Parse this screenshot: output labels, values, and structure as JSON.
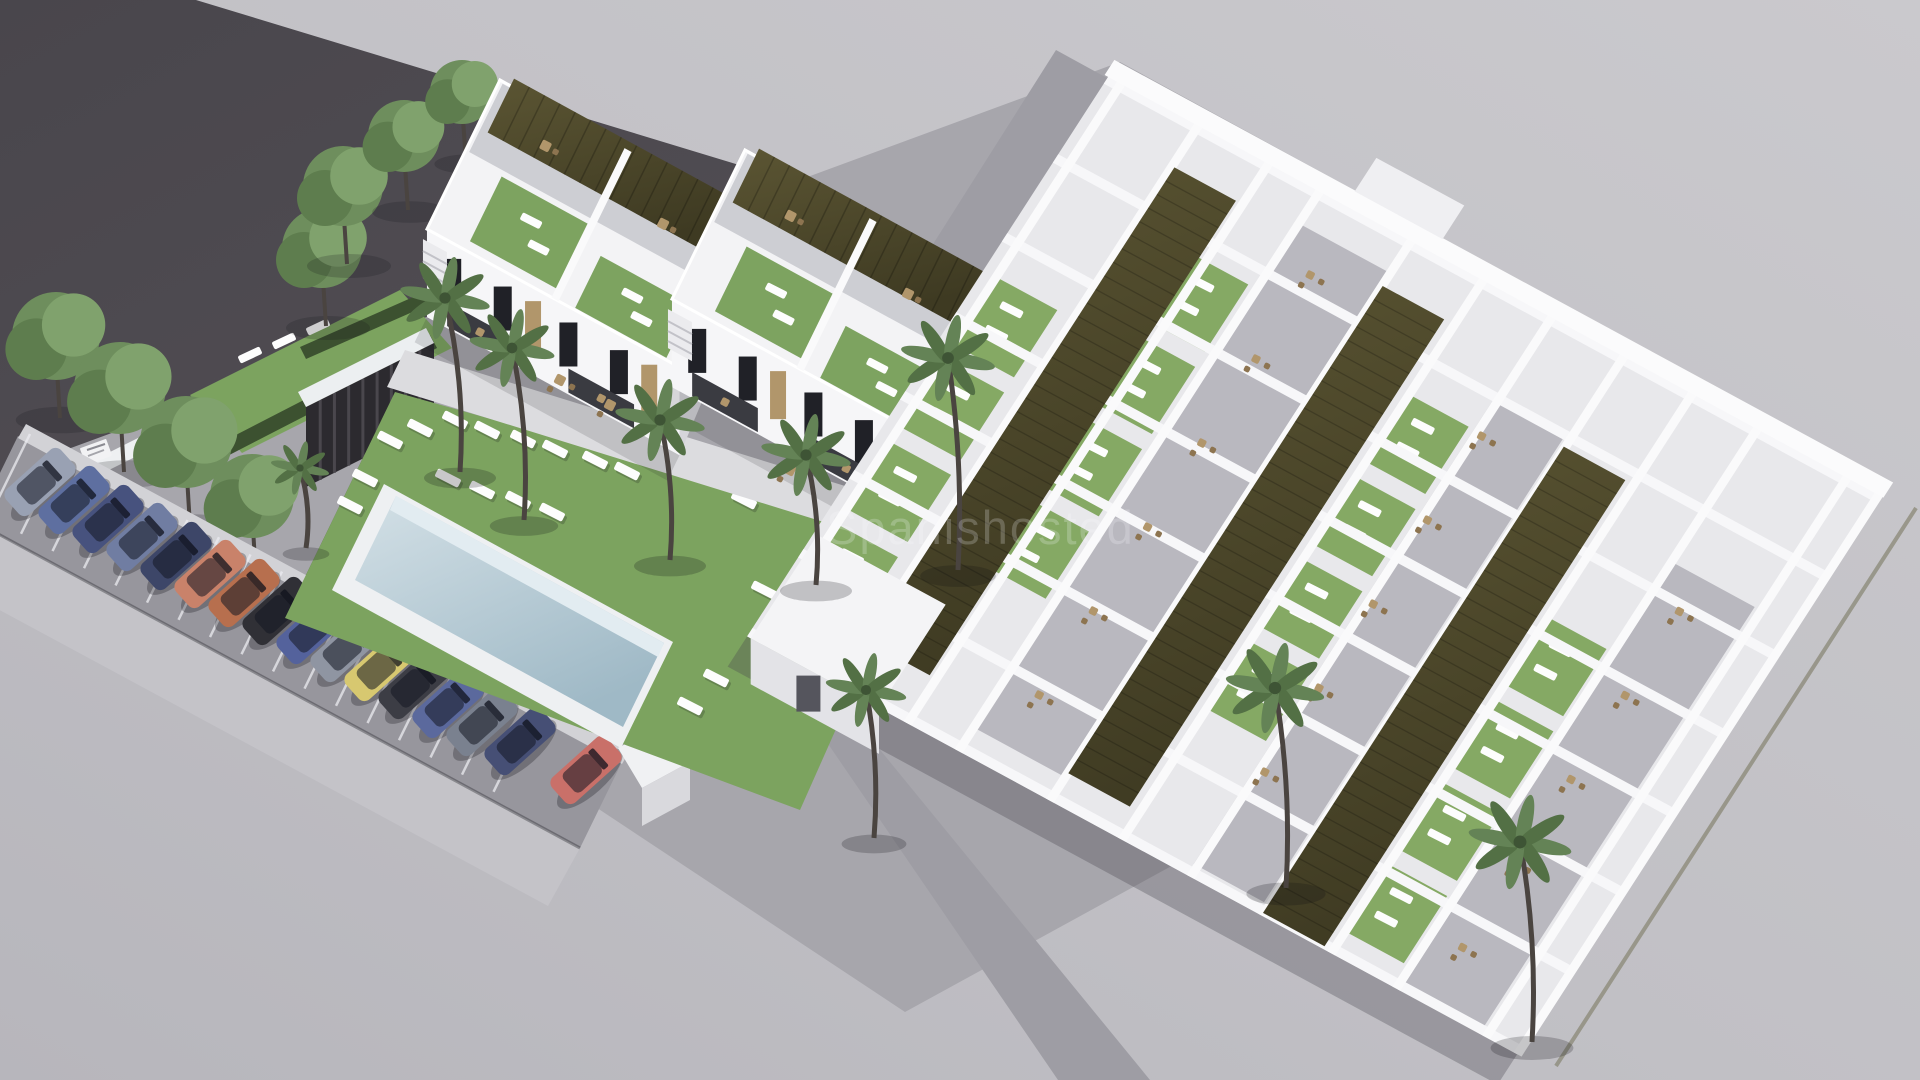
{
  "watermark": {
    "text": "Spanishosted"
  },
  "scene": {
    "type": "3d-architectural-render",
    "description": "Aerial render of a white residential development: two-storey townhouses with olive pergola roof terraces, communal lawn with swimming pool and sun loungers, palm trees, angle-parked cars along the street, and a large single-storey apartment complex with three long olive pergola strips, green patios and grey terraces.",
    "palette": {
      "bgLight": "#cac9cd",
      "bgDark": "#b7b6bc",
      "parcel1": "#49464c",
      "parcel2": "#5e5a60",
      "site": "#a7a6ac",
      "road": "#9e9da4",
      "asphalt": "#97969d",
      "sidewalk": "#c4c3c8",
      "lawn": "#7ca35f",
      "lawnBright": "#86ab66",
      "hedge": "#3c5130",
      "poolRim": "#eef0f2",
      "water1": "#d3e0e6",
      "water2": "#9fb9c6",
      "waterEdge": "#e2ecf1",
      "white": "#f6f6f8",
      "whiteShade": "#d5d5da",
      "whiteDark": "#bfbfc5",
      "pergola1": "#5b5533",
      "pergola2": "#3e3a22",
      "turf": "#7da360",
      "tan": "#b1966b",
      "tanDark": "#8d7450",
      "window": "#202127",
      "recess": "#3a3b41",
      "trunk": "#4a4440",
      "frond1": "#537045",
      "frond2": "#648356",
      "tree1": "#6e8e5d",
      "tree2": "#80a26d",
      "tree3": "#5e7d4e",
      "slat": "#2c2a2f",
      "slatLine": "#4a474d"
    },
    "axes": {
      "U": [
        0.877,
        0.48
      ],
      "V": [
        -0.44,
        0.898
      ]
    },
    "parcel": [
      [
        0,
        0
      ],
      [
        196,
        0
      ],
      [
        1335,
        346
      ],
      [
        900,
        700
      ],
      [
        0,
        548
      ]
    ],
    "site": [
      [
        60,
        452
      ],
      [
        1120,
        62
      ],
      [
        1880,
        478
      ],
      [
        905,
        1012
      ]
    ],
    "roads": [
      [
        [
          1056,
          50
        ],
        [
          1118,
          84
        ],
        [
          760,
          646
        ],
        [
          700,
          612
        ]
      ],
      [
        [
          757,
          640
        ],
        [
          818,
          674
        ],
        [
          1150,
          1080
        ],
        [
          1058,
          1080
        ]
      ]
    ],
    "upperLawn": {
      "poly": [
        [
          190,
          395
        ],
        [
          400,
          290
        ],
        [
          452,
          348
        ],
        [
          242,
          453
        ]
      ],
      "loungers": [
        [
          250,
          355
        ],
        [
          284,
          341
        ],
        [
          318,
          327
        ]
      ]
    },
    "hedges": [
      [
        [
          168,
          470
        ],
        [
          430,
          335
        ],
        [
          437,
          348
        ],
        [
          175,
          483
        ]
      ],
      [
        [
          300,
          347
        ],
        [
          470,
          272
        ],
        [
          476,
          284
        ],
        [
          306,
          359
        ]
      ],
      [
        [
          285,
          618
        ],
        [
          395,
          392
        ],
        [
          403,
          398
        ],
        [
          293,
          624
        ]
      ]
    ],
    "slatBuilding": {
      "cap": [
        [
          298,
          392
        ],
        [
          426,
          328
        ],
        [
          434,
          343
        ],
        [
          306,
          407
        ]
      ],
      "front": [
        [
          306,
          407
        ],
        [
          434,
          343
        ],
        [
          434,
          423
        ],
        [
          306,
          487
        ]
      ],
      "slats": 9
    },
    "sign": {
      "x": 96,
      "y": 452,
      "w": 28,
      "h": 18,
      "rot": -20
    },
    "gateWall": [
      [
        82,
        466
      ],
      [
        158,
        428
      ],
      [
        165,
        442
      ],
      [
        89,
        480
      ]
    ],
    "trees": [
      [
        56,
        336,
        44
      ],
      [
        120,
        388,
        46
      ],
      [
        186,
        442,
        46
      ],
      [
        252,
        496,
        42
      ],
      [
        322,
        248,
        40
      ],
      [
        343,
        186,
        40
      ],
      [
        404,
        136,
        36
      ],
      [
        462,
        92,
        32
      ]
    ],
    "parking": {
      "asphalt": [
        [
          18,
          436
        ],
        [
          622,
          762
        ],
        [
          580,
          848
        ],
        [
          -24,
          522
        ]
      ],
      "sidewalk": [
        [
          -24,
          522
        ],
        [
          580,
          848
        ],
        [
          548,
          906
        ],
        [
          -56,
          580
        ]
      ],
      "lowWall": [
        [
          26,
          424
        ],
        [
          630,
          750
        ],
        [
          622,
          764
        ],
        [
          18,
          438
        ]
      ],
      "bays": {
        "start": [
          30,
          434
        ],
        "step": [
          31.5,
          17.2
        ],
        "count": 17,
        "len": 92
      },
      "endPillar": {
        "top": [
          [
            618,
            748
          ],
          [
            666,
            722
          ],
          [
            690,
            762
          ],
          [
            642,
            788
          ]
        ],
        "face": [
          [
            642,
            788
          ],
          [
            690,
            762
          ],
          [
            690,
            800
          ],
          [
            642,
            826
          ]
        ]
      },
      "carSize": {
        "len": 74,
        "wid": 34,
        "rot": -42
      },
      "cars": [
        {
          "x": 40,
          "y": 482,
          "color": "#99a1b3"
        },
        {
          "x": 74,
          "y": 500,
          "color": "#5e6fa0"
        },
        {
          "x": 108,
          "y": 519,
          "color": "#47527e"
        },
        {
          "x": 142,
          "y": 537,
          "color": "#707da2"
        },
        {
          "x": 176,
          "y": 556,
          "color": "#3d4668"
        },
        {
          "x": 210,
          "y": 574,
          "color": "#c9826a"
        },
        {
          "x": 244,
          "y": 593,
          "color": "#b76f4e"
        },
        {
          "x": 278,
          "y": 611,
          "color": "#303036"
        },
        {
          "x": 312,
          "y": 630,
          "color": "#54629c"
        },
        {
          "x": 346,
          "y": 648,
          "color": "#8f95a2"
        },
        {
          "x": 380,
          "y": 667,
          "color": "#d7c870"
        },
        {
          "x": 414,
          "y": 685,
          "color": "#3c3d45"
        },
        {
          "x": 448,
          "y": 704,
          "color": "#5b699d"
        },
        {
          "x": 482,
          "y": 722,
          "color": "#7a818f"
        },
        {
          "x": 520,
          "y": 741,
          "color": "#464f75"
        },
        {
          "x": 586,
          "y": 770,
          "color": "#c97069"
        }
      ]
    },
    "mainLawn": [
      [
        395,
        392
      ],
      [
        920,
        540
      ],
      [
        800,
        810
      ],
      [
        285,
        618
      ]
    ],
    "pool": {
      "rim": [
        [
          384,
          484
        ],
        [
          673,
          642
        ],
        [
          621,
          748
        ],
        [
          332,
          590
        ]
      ],
      "water": [
        [
          396,
          496
        ],
        [
          664,
          643
        ],
        [
          623,
          727
        ],
        [
          355,
          580
        ]
      ],
      "edge": [
        [
          396,
          496
        ],
        [
          664,
          643
        ],
        [
          658,
          657
        ],
        [
          390,
          510
        ]
      ]
    },
    "poolLoungers": [
      [
        455,
        420
      ],
      [
        487,
        430
      ],
      [
        523,
        439
      ],
      [
        555,
        449
      ],
      [
        595,
        460
      ],
      [
        627,
        471
      ],
      [
        448,
        478
      ],
      [
        482,
        490
      ],
      [
        518,
        500
      ],
      [
        552,
        512
      ],
      [
        390,
        440
      ],
      [
        420,
        428
      ],
      [
        365,
        478
      ],
      [
        350,
        505
      ],
      [
        744,
        500
      ],
      [
        764,
        590
      ],
      [
        716,
        678
      ],
      [
        690,
        706
      ]
    ],
    "pathBand": [
      [
        405,
        350
      ],
      [
        955,
        520
      ],
      [
        937,
        557
      ],
      [
        387,
        387
      ]
    ],
    "townhouses": [
      {
        "anchor": [
          500,
          80
        ]
      },
      {
        "anchor": [
          745,
          150
        ]
      }
    ],
    "townhouseSpec": {
      "du": 288,
      "dw": 166,
      "facadeH": 88,
      "pergola": {
        "u0": 12,
        "len": 262,
        "w0": -8,
        "w1": 52
      },
      "backTerrace": {
        "w0": 2,
        "w1": 78
      },
      "patches": [
        {
          "u": 44,
          "w": 84,
          "du": 104,
          "dw": 72
        },
        {
          "u": 168,
          "w": 106,
          "du": 104,
          "dw": 58
        }
      ],
      "roofTables": [
        {
          "u": 70,
          "w": 36
        },
        {
          "u": 210,
          "w": 48
        }
      ],
      "windows": [
        0.1,
        0.3,
        0.56,
        0.76
      ],
      "accents": [
        0.42,
        0.88
      ],
      "recesses": [
        {
          "f0": 0.08,
          "f1": 0.34
        },
        {
          "f0": 0.56,
          "f1": 0.82
        }
      ],
      "divider": 142
    },
    "terraceFurniture": [
      [
        560,
        380
      ],
      [
        610,
        405
      ],
      [
        790,
        470
      ],
      [
        845,
        498
      ],
      [
        930,
        545
      ]
    ],
    "complex": {
      "N": [
        1118,
        80
      ],
      "U": [
        0.879,
        0.477
      ],
      "W": [
        -0.542,
        0.84
      ],
      "ulen": 866,
      "wlen": 668,
      "terrCols": [
        [
          230,
          330,
          40,
          640
        ],
        [
          490,
          570,
          100,
          655
        ],
        [
          733,
          823,
          160,
          668
        ]
      ],
      "lawnCols": [
        {
          "u0": 8,
          "ws": [
            232,
            330,
            428,
            526
          ]
        },
        {
          "u0": 155,
          "ws": [
            118,
            216,
            314,
            412
          ]
        },
        {
          "u0": 418,
          "ws": [
            138,
            236,
            334,
            432
          ]
        },
        {
          "u0": 655,
          "ws": [
            268,
            366,
            464,
            562
          ]
        }
      ],
      "lawnCell": {
        "du": 66,
        "dh": 80
      },
      "wallsU": [
        0,
        94,
        188,
        282,
        376,
        470,
        564,
        658
      ],
      "wallsW": [
        0,
        88,
        168,
        226,
        330,
        412,
        490,
        572,
        650,
        724,
        826,
        862
      ],
      "edgeBand": {
        "w0": -16,
        "w1": 2
      },
      "topBlock": {
        "u0": 260,
        "u1": 360,
        "w0": -55,
        "w1": -15
      },
      "strips": [
        [
          95,
          165,
          50,
          615
        ],
        [
          335,
          405,
          55,
          635
        ],
        [
          575,
          645,
          110,
          665
        ]
      ],
      "chairs": [
        {
          "u": 268,
          "ws": [
            80,
            180,
            280,
            380,
            480,
            580
          ]
        },
        {
          "u": 500,
          "ws": [
            140,
            240,
            340,
            440,
            540
          ]
        },
        {
          "u": 762,
          "ws": [
            200,
            300,
            400,
            500,
            600
          ]
        }
      ],
      "entrance": {
        "u0": -6,
        "u1": 140,
        "w0": 545,
        "w1": 668,
        "drop": 46
      },
      "shadowS": {
        "w0": 668,
        "w1": 704
      },
      "fence": [
        [
          1916,
          508
        ],
        [
          1556,
          1066
        ]
      ]
    },
    "palms": [
      {
        "cx": 445,
        "cy": 298,
        "r": 40,
        "bx": 460,
        "by": 472
      },
      {
        "cx": 512,
        "cy": 348,
        "r": 38,
        "bx": 524,
        "by": 520
      },
      {
        "cx": 660,
        "cy": 420,
        "r": 40,
        "bx": 670,
        "by": 560
      },
      {
        "cx": 806,
        "cy": 455,
        "r": 40,
        "bx": 816,
        "by": 585
      },
      {
        "cx": 948,
        "cy": 358,
        "r": 42,
        "bx": 958,
        "by": 570
      },
      {
        "cx": 300,
        "cy": 468,
        "r": 26,
        "bx": 306,
        "by": 548
      },
      {
        "cx": 1275,
        "cy": 688,
        "r": 44,
        "bx": 1286,
        "by": 888
      },
      {
        "cx": 1520,
        "cy": 842,
        "r": 46,
        "bx": 1532,
        "by": 1042
      },
      {
        "cx": 866,
        "cy": 690,
        "r": 36,
        "bx": 874,
        "by": 838
      }
    ],
    "counts": {
      "cars": 16,
      "palms": 9,
      "trees": 8,
      "pergolaStrips": 3,
      "townhouses": 2
    }
  }
}
